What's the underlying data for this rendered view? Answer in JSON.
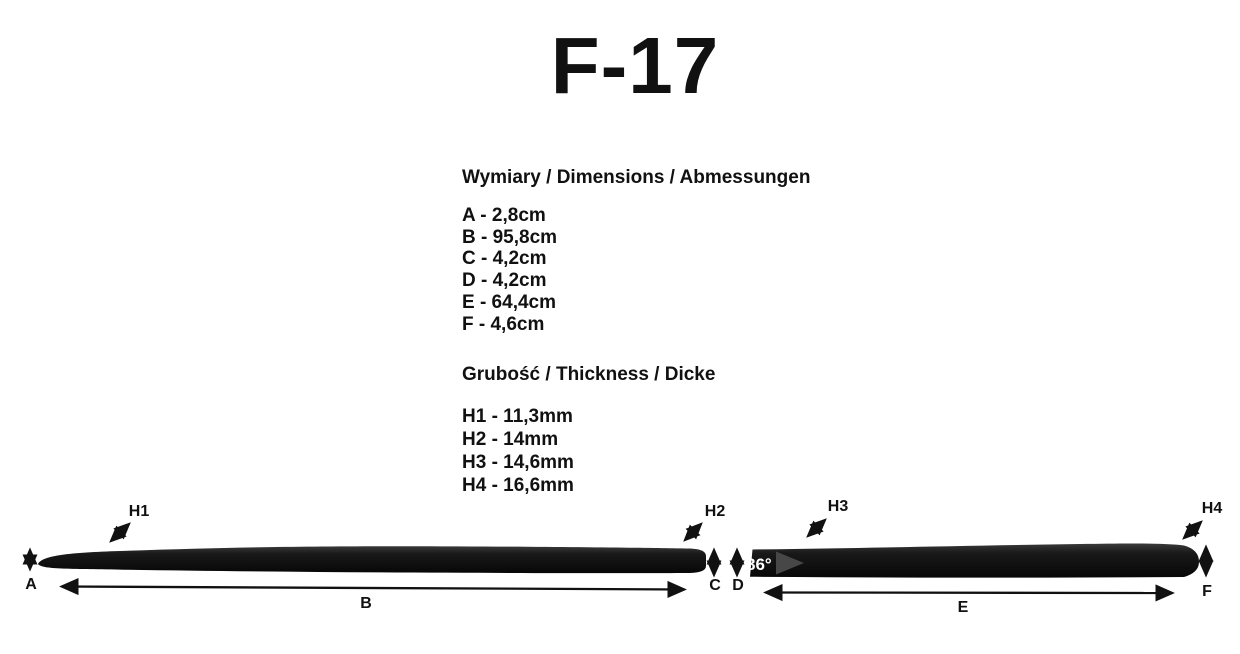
{
  "title": "F-17",
  "dimensions_section": {
    "heading": "Wymiary / Dimensions / Abmessungen",
    "lines": [
      "A - 2,8cm",
      "B - 95,8cm",
      "C - 4,2cm",
      "D - 4,2cm",
      "E - 64,4cm",
      "F - 4,6cm"
    ]
  },
  "thickness_section": {
    "heading": "Grubość / Thickness / Dicke",
    "lines": [
      "H1 - 11,3mm",
      "H2 - 14mm",
      "H3 - 14,6mm",
      "H4 - 16,6mm"
    ]
  },
  "diagram": {
    "angle_label": "86°",
    "labels": {
      "h1": "H1",
      "h2": "H2",
      "h3": "H3",
      "h4": "H4",
      "a": "A",
      "b": "B",
      "c": "C",
      "d": "D",
      "e": "E",
      "f": "F"
    },
    "colors": {
      "strip": "#111111",
      "angle_cut_triangle": "#474747",
      "angle_text": "#ffffff",
      "text": "#111111",
      "background": "#ffffff"
    }
  }
}
